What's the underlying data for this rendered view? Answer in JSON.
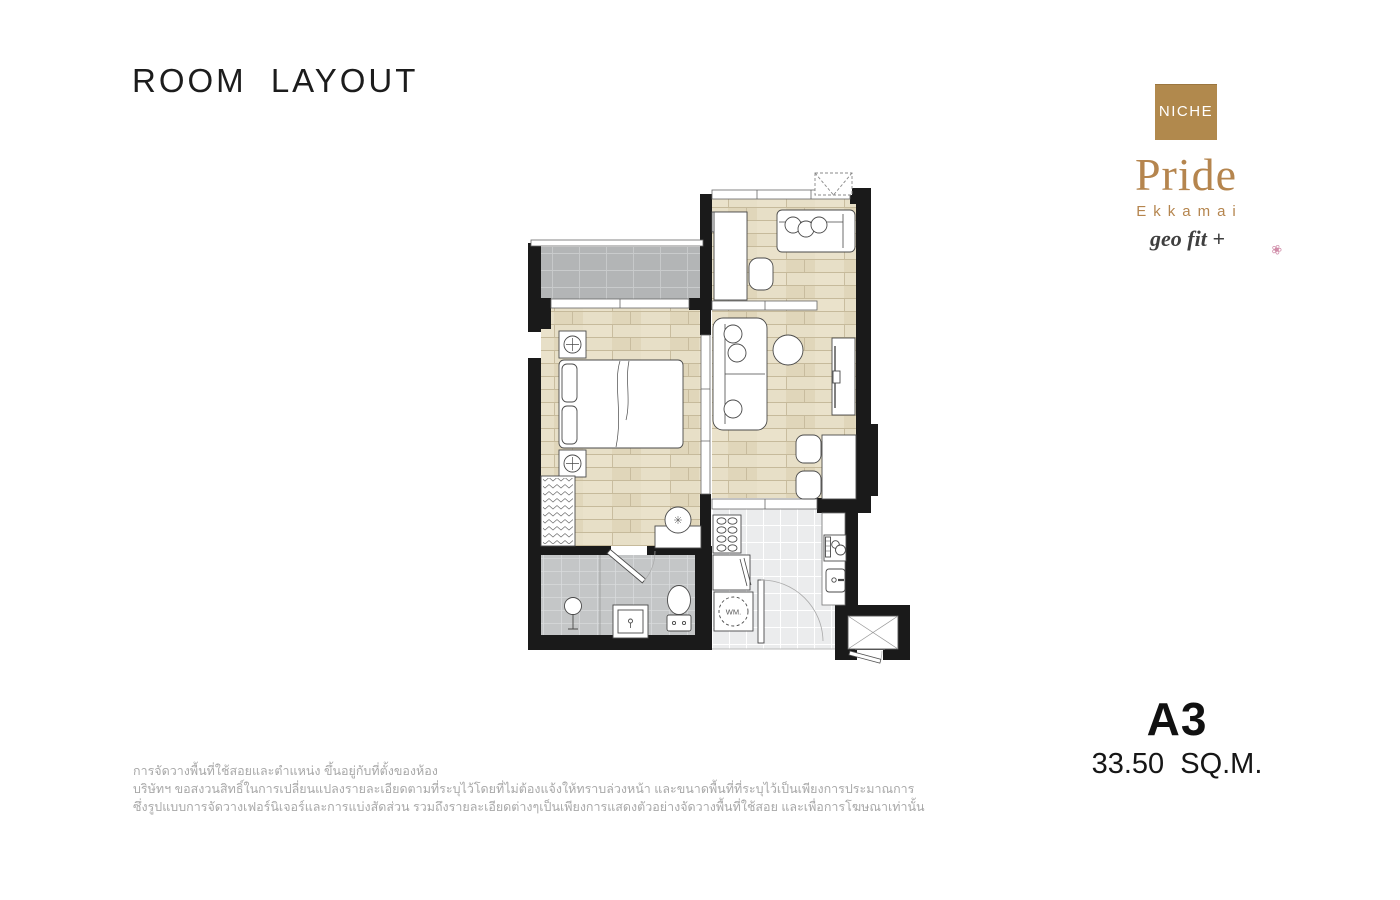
{
  "header": {
    "title": "ROOM LAYOUT"
  },
  "logo": {
    "badge": "NICHE",
    "brand": "Pride",
    "location": "Ekkamai",
    "tagline": "geo fit +"
  },
  "unit": {
    "type": "A3",
    "area": "33.50 SQ.M."
  },
  "floor_plan": {
    "washing_machine_label": "WM."
  },
  "disclaimer": {
    "line1": "การจัดวางพื้นที่ใช้สอยและตำแหน่ง ขึ้นอยู่กับที่ตั้งของห้อง",
    "line2": "บริษัทฯ ขอสงวนสิทธิ์ในการเปลี่ยนแปลงรายละเอียดตามที่ระบุไว้โดยที่ไม่ต้องแจ้งให้ทราบล่วงหน้า และขนาดพื้นที่ที่ระบุไว้เป็นเพียงการประมาณการ",
    "line3": "ซึ่งรูปแบบการจัดวางเฟอร์นิเจอร์และการแบ่งสัดส่วน รวมถึงรายละเอียดต่างๆเป็นเพียงการแสดงตัวอย่างจัดวางพื้นที่ใช้สอย และเพื่อการโฆษณาเท่านั้น"
  },
  "colors": {
    "brand_gold": "#b1894d",
    "brand_text_gold": "#b5854e",
    "wall_black": "#1a1a1a",
    "wood_floor": "#e7dfc7",
    "balcony_tile": "#b3b5b6",
    "bathroom_tile": "#c4c6c7",
    "kitchen_tile": "#ebeced",
    "flower_pink": "#d08ca8"
  }
}
